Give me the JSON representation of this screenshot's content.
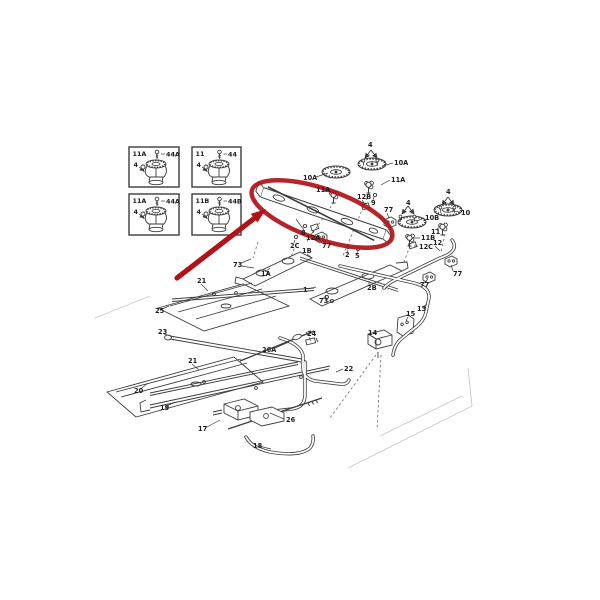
{
  "figure": {
    "description": "Exploded parts diagram of gas range maintop burner assembly with red callout",
    "colors": {
      "background": "#ffffff",
      "ink": "#3c3c3c",
      "ink_dark": "#161616",
      "annotation_red": "#b01218",
      "ghost": "#c9c9c9"
    },
    "insets": [
      {
        "part": "11A",
        "fastener": "44A",
        "qty": "4",
        "x": 129,
        "y": 147,
        "w": 50,
        "h": 40
      },
      {
        "part": "11",
        "fastener": "44",
        "qty": "4",
        "x": 192,
        "y": 147,
        "w": 49,
        "h": 40
      },
      {
        "part": "11A",
        "fastener": "44A",
        "qty": "4",
        "x": 129,
        "y": 194,
        "w": 50,
        "h": 41
      },
      {
        "part": "11B",
        "fastener": "44B",
        "qty": "4",
        "x": 192,
        "y": 194,
        "w": 49,
        "h": 41
      }
    ],
    "labels": [
      {
        "t": "4",
        "x": 368,
        "y": 147
      },
      {
        "t": "10A",
        "x": 394,
        "y": 165,
        "lead": [
          393,
          163,
          382,
          166
        ]
      },
      {
        "t": "11A",
        "x": 391,
        "y": 182,
        "lead": [
          390,
          180,
          381,
          185
        ]
      },
      {
        "t": "10A",
        "x": 303,
        "y": 180,
        "lead": [
          316,
          177,
          328,
          173
        ]
      },
      {
        "t": "11A",
        "x": 316,
        "y": 192,
        "lead": [
          327,
          190,
          335,
          194
        ]
      },
      {
        "t": "12B",
        "x": 357,
        "y": 199,
        "lead": [
          362,
          200,
          366,
          206
        ]
      },
      {
        "t": "9",
        "x": 371,
        "y": 205,
        "lead": [
          373,
          200,
          374,
          197
        ]
      },
      {
        "t": "77",
        "x": 384,
        "y": 212,
        "lead": [
          387,
          213,
          389,
          218
        ]
      },
      {
        "t": "4",
        "x": 406,
        "y": 205
      },
      {
        "t": "4",
        "x": 446,
        "y": 194
      },
      {
        "t": "10",
        "x": 461,
        "y": 215,
        "lead": [
          460,
          212,
          452,
          211
        ]
      },
      {
        "t": "10B",
        "x": 425,
        "y": 220,
        "lead": [
          424,
          218,
          417,
          221
        ]
      },
      {
        "t": "11",
        "x": 431,
        "y": 234,
        "lead": [
          435,
          230,
          440,
          227
        ]
      },
      {
        "t": "11B",
        "x": 421,
        "y": 240,
        "lead": [
          420,
          238,
          414,
          238
        ]
      },
      {
        "t": "12C",
        "x": 419,
        "y": 249,
        "lead": [
          418,
          246,
          414,
          246
        ]
      },
      {
        "t": "12",
        "x": 433,
        "y": 245,
        "lead": [
          435,
          246,
          440,
          251
        ]
      },
      {
        "t": "8",
        "x": 301,
        "y": 235,
        "lead": [
          304,
          230,
          296,
          219
        ]
      },
      {
        "t": "12A",
        "x": 306,
        "y": 240,
        "lead": [
          311,
          235,
          314,
          230
        ]
      },
      {
        "t": "2C",
        "x": 290,
        "y": 248,
        "lead": [
          294,
          243,
          295,
          240
        ]
      },
      {
        "t": "77",
        "x": 322,
        "y": 248,
        "lead": [
          324,
          243,
          321,
          239
        ]
      },
      {
        "t": "1B",
        "x": 302,
        "y": 253,
        "lead": [
          307,
          254,
          312,
          258
        ]
      },
      {
        "t": "2",
        "x": 345,
        "y": 257,
        "lead": [
          347,
          252,
          348,
          250
        ]
      },
      {
        "t": "5",
        "x": 355,
        "y": 258,
        "lead": [
          357,
          253,
          358,
          251
        ]
      },
      {
        "t": "2B",
        "x": 367,
        "y": 290,
        "lead": [
          369,
          285,
          369,
          281
        ]
      },
      {
        "t": "77",
        "x": 453,
        "y": 276,
        "lead": [
          453,
          271,
          451,
          265
        ]
      },
      {
        "t": "77",
        "x": 420,
        "y": 287,
        "lead": [
          424,
          283,
          428,
          279
        ]
      },
      {
        "t": "13",
        "x": 417,
        "y": 311,
        "lead": [
          422,
          308,
          427,
          304
        ]
      },
      {
        "t": "15",
        "x": 406,
        "y": 316,
        "lead": [
          408,
          317,
          406,
          321
        ]
      },
      {
        "t": "14",
        "x": 368,
        "y": 335,
        "lead": [
          372,
          336,
          376,
          339
        ]
      },
      {
        "t": "22",
        "x": 344,
        "y": 371,
        "lead": [
          343,
          369,
          336,
          372
        ]
      },
      {
        "t": "24",
        "x": 307,
        "y": 336,
        "lead": [
          309,
          337,
          311,
          341
        ]
      },
      {
        "t": "26A",
        "x": 262,
        "y": 352,
        "lead": [
          275,
          348,
          289,
          342
        ]
      },
      {
        "t": "73",
        "x": 233,
        "y": 267,
        "lead": [
          241,
          263,
          251,
          259
        ],
        "lead2": [
          241,
          266,
          254,
          268
        ]
      },
      {
        "t": "1A",
        "x": 261,
        "y": 276,
        "lead": [
          265,
          272,
          270,
          268
        ]
      },
      {
        "t": "1",
        "x": 303,
        "y": 292,
        "lead": [
          308,
          289,
          316,
          287
        ]
      },
      {
        "t": "73",
        "x": 319,
        "y": 303,
        "lead": [
          323,
          299,
          326,
          295
        ],
        "lead2": [
          326,
          303,
          331,
          300
        ]
      },
      {
        "t": "21",
        "x": 197,
        "y": 283,
        "lead": [
          201,
          284,
          208,
          291
        ]
      },
      {
        "t": "25",
        "x": 155,
        "y": 313,
        "lead": [
          160,
          310,
          169,
          306
        ]
      },
      {
        "t": "23",
        "x": 158,
        "y": 334,
        "lead": [
          164,
          334,
          174,
          337
        ]
      },
      {
        "t": "21",
        "x": 188,
        "y": 363,
        "lead": [
          192,
          364,
          199,
          370
        ]
      },
      {
        "t": "20",
        "x": 134,
        "y": 393,
        "lead": [
          139,
          390,
          147,
          384
        ]
      },
      {
        "t": "19",
        "x": 160,
        "y": 410,
        "lead": [
          165,
          407,
          175,
          402
        ]
      },
      {
        "t": "17",
        "x": 198,
        "y": 431,
        "lead": [
          205,
          428,
          220,
          420
        ]
      },
      {
        "t": "26",
        "x": 286,
        "y": 422,
        "lead": [
          284,
          419,
          270,
          413
        ]
      },
      {
        "t": "18",
        "x": 253,
        "y": 448,
        "lead": [
          259,
          446,
          271,
          449
        ]
      }
    ],
    "annotation": {
      "ellipse": {
        "cx": 322,
        "cy": 214,
        "rx": 74,
        "ry": 25,
        "angle": 19
      },
      "arrow": {
        "x1": 177,
        "y1": 278,
        "x2": 256,
        "y2": 217,
        "tip_x": 266,
        "tip_y": 209
      }
    }
  }
}
